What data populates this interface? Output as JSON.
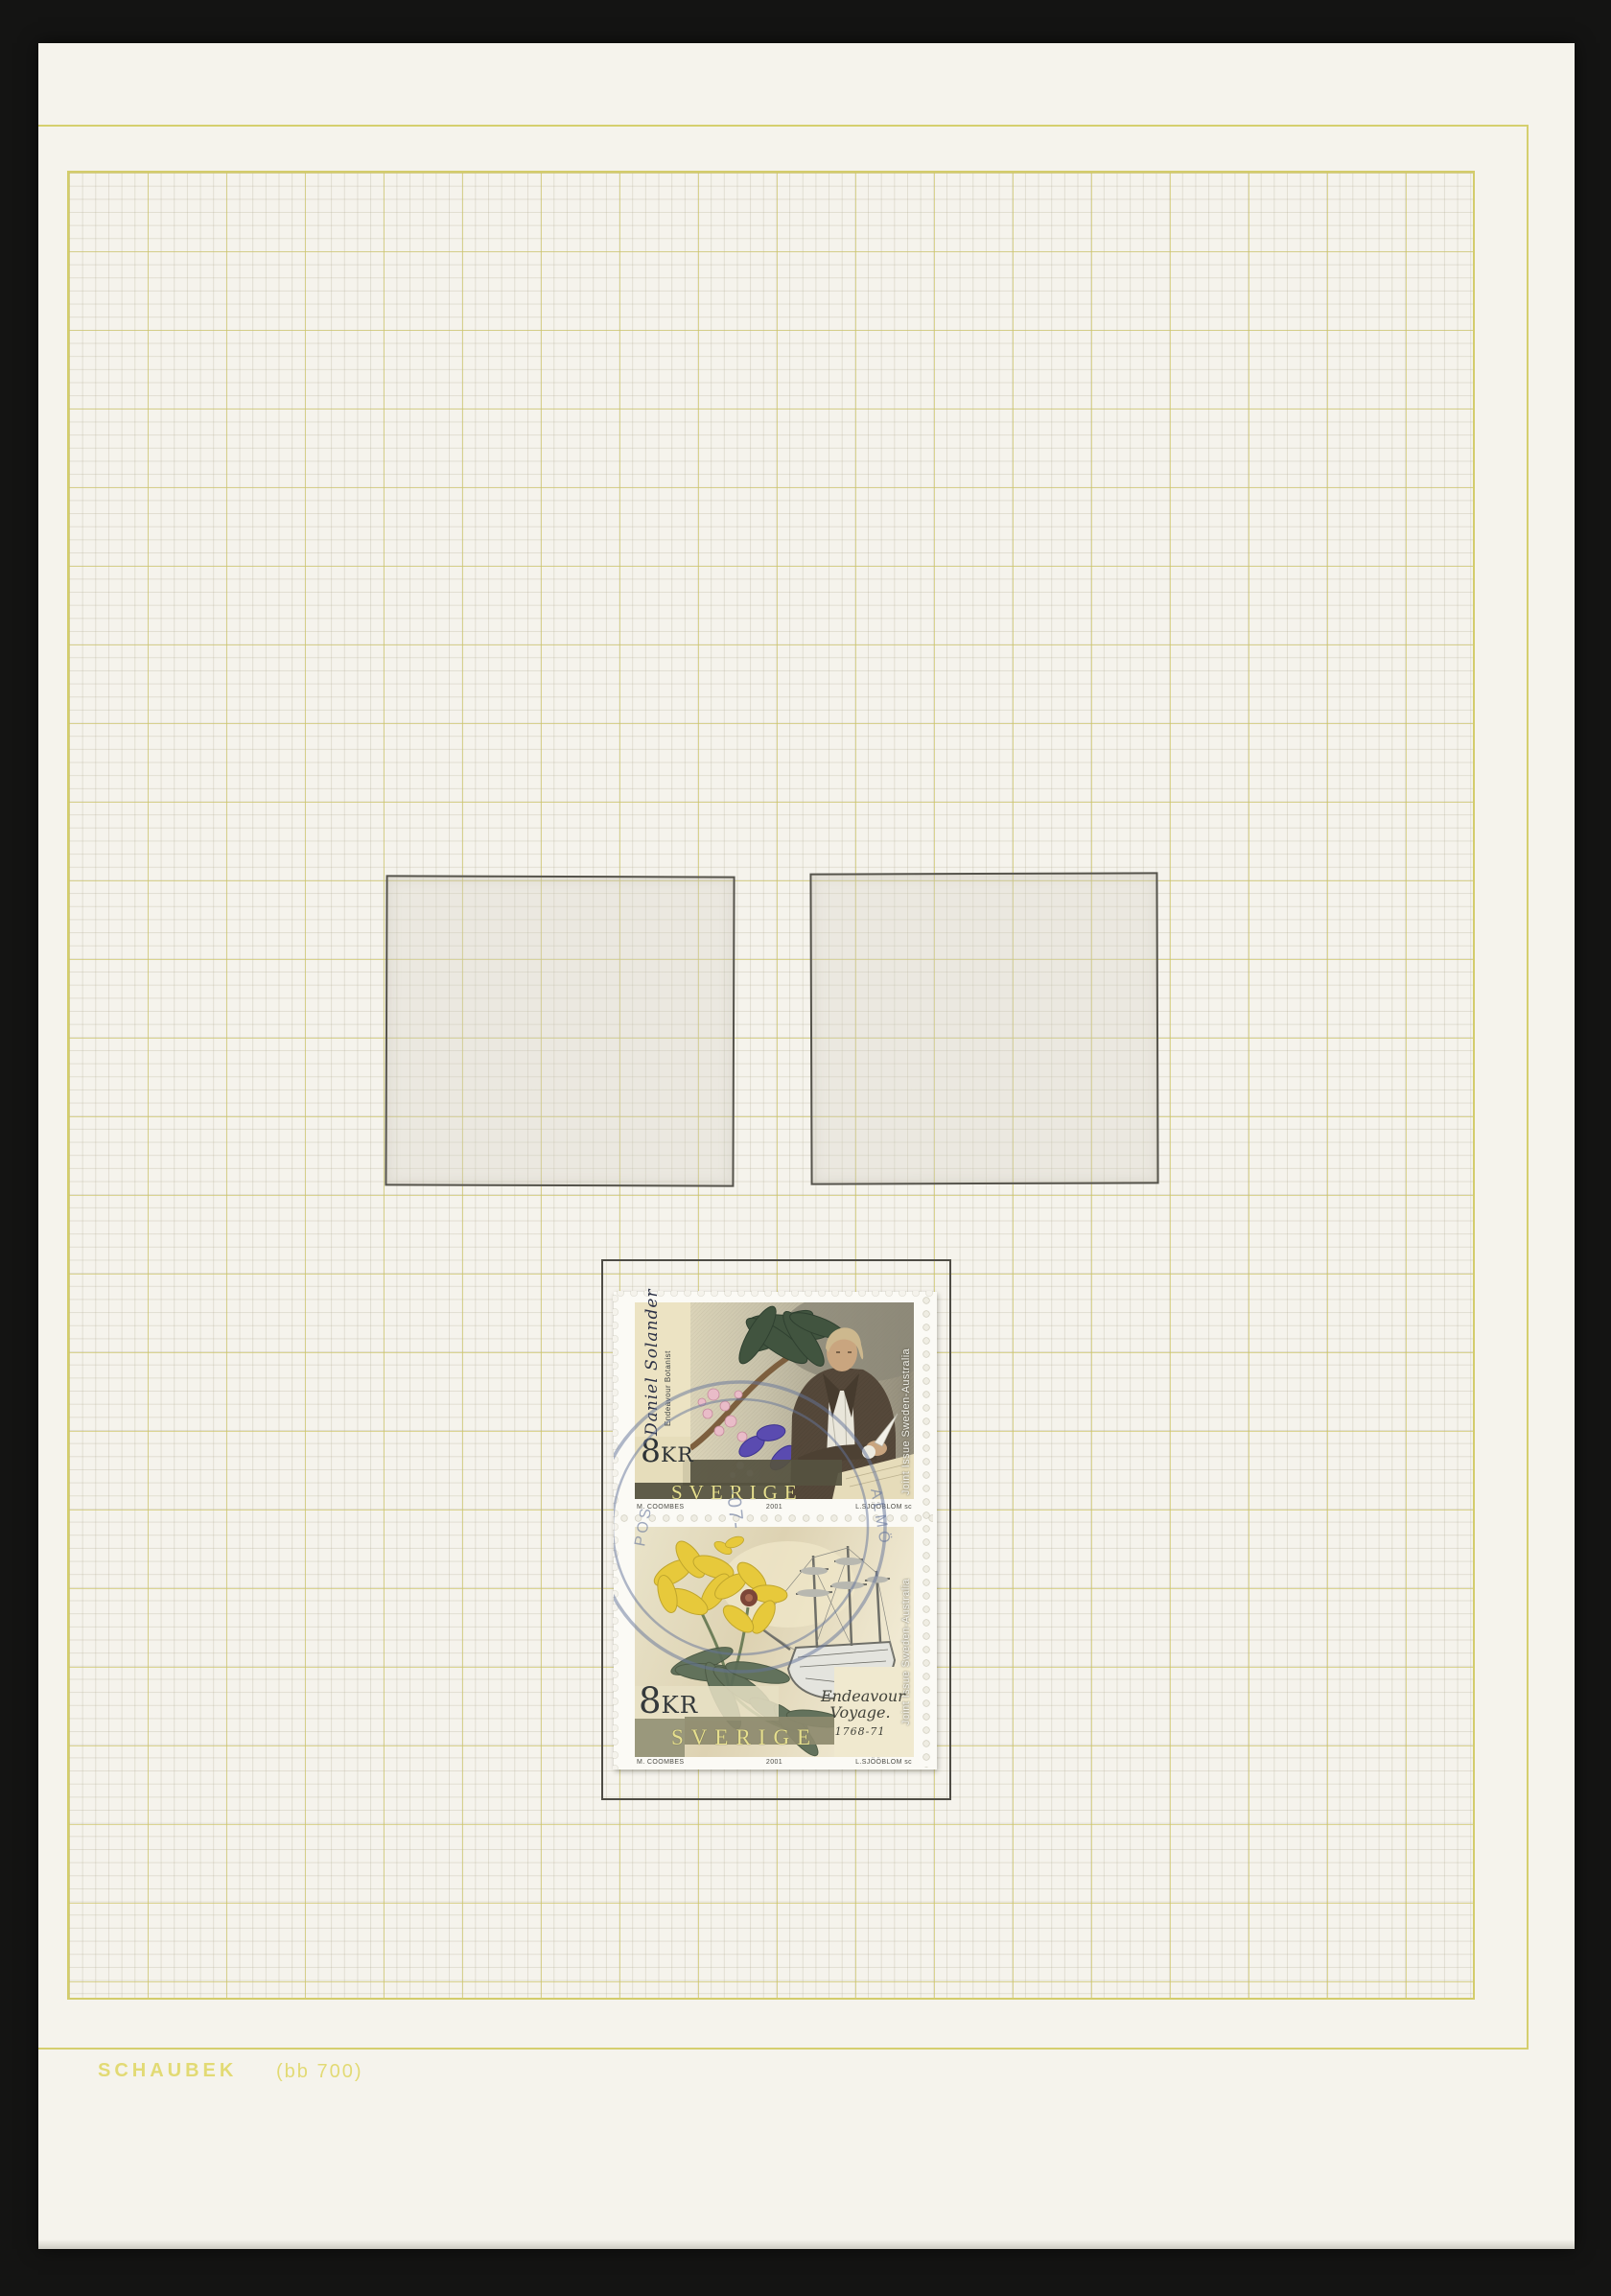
{
  "album_page": {
    "brand": "SCHAUBEK",
    "code": "(bb 700)"
  },
  "stamp_block": {
    "top_stamp": {
      "script_name": "Daniel Solander",
      "subtitle": "Endeavour Botanist",
      "denomination_number": "8",
      "denomination_unit": "KR",
      "country": "SVERIGE",
      "side_label": "Joint Issue Sweden-Australia"
    },
    "bottom_stamp": {
      "script_line": "Endeavour Voyage.",
      "years": "1768-71",
      "denomination_number": "8",
      "denomination_unit": "KR",
      "country": "SVERIGE",
      "side_label": "Joint Issue Sweden-Australia"
    },
    "credits": {
      "designer": "M. COOMBES",
      "year": "2001",
      "engraver": "L.SJÖÖBLOM sc"
    }
  },
  "postmark": {
    "fragment_left": "POS",
    "fragment_date": "-07-",
    "fragment_right": "ALMÖ"
  },
  "colors": {
    "photo_background": "#141413",
    "page": "#f5f3ec",
    "frame_yellow": "#d5cf6e",
    "grid_minor": "#dedacb",
    "pencil_outline": "#4e4c45",
    "brand_text": "#e2da74",
    "postmark_blue": "#64749b",
    "sverige_lettering": "#e6df8e",
    "flower_yellow": "#e7c93b",
    "fruit_purple": "#5a4bb0"
  }
}
